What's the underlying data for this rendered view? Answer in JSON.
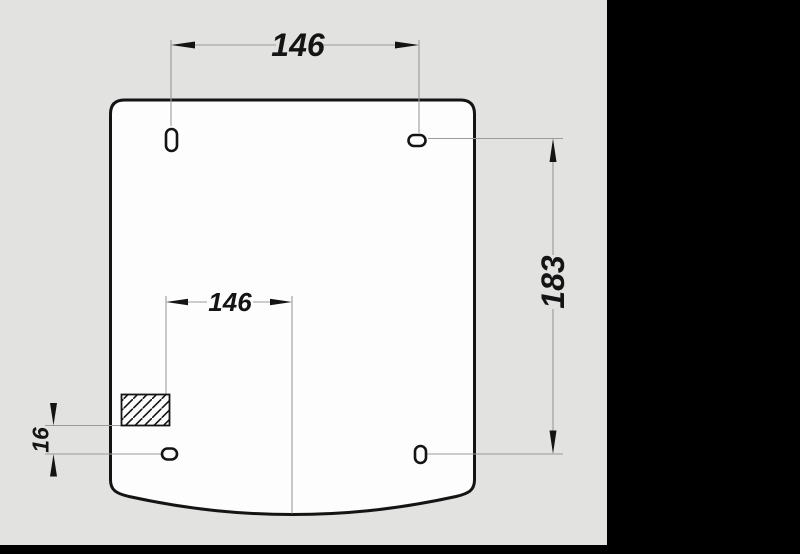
{
  "scene": {
    "description": "Technical drawing of a rounded rectangular panel (lid top view) with four mounting slots, a hatched fixing area and dimension callouts",
    "sheet_color": "#e2e2e0",
    "background_color": "#000000",
    "ink_color": "#141414",
    "dim_line_color": "#9b9b9b",
    "panel_fill": "#fdfdfd"
  },
  "dimensions": {
    "top_width": "146",
    "inner_width": "146",
    "right_height": "183",
    "left_offset": "16"
  },
  "features": {
    "panel": "panel outline with curved bottom edge",
    "slots": [
      "vertical slot top-left",
      "horizontal slot top-right",
      "horizontal slot bottom-left",
      "vertical slot bottom-right"
    ],
    "hatch_area": "diagonally hatched rectangle near lower-left"
  }
}
